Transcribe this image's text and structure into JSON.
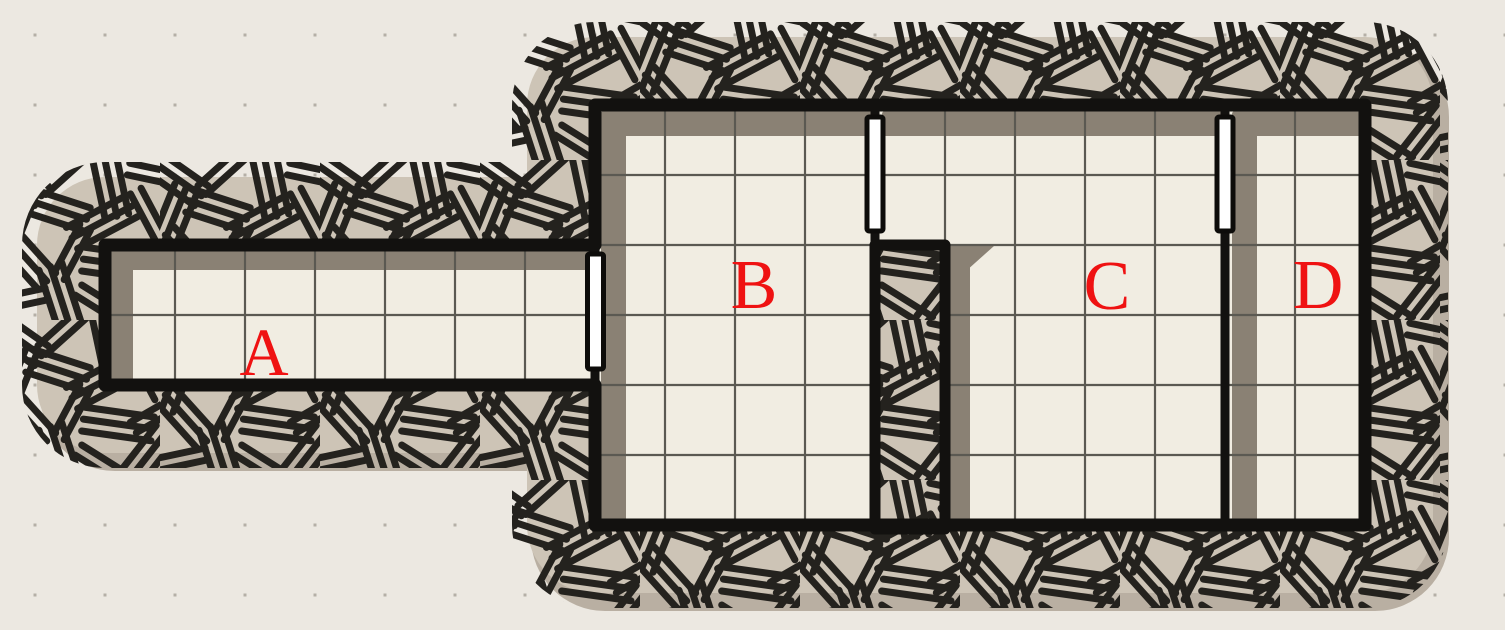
{
  "map": {
    "title": "dungeon-map",
    "canvas": {
      "width": 1505,
      "height": 630
    },
    "colors": {
      "background": "#ECE8E1",
      "dot": "#B5AFA6",
      "rock_fill": "#CDC4B6",
      "drop_shadow": "#B9AFA2",
      "hatch_ink": "#24221E",
      "wall_ink": "#12110F",
      "floor": "#F1EDE2",
      "floor_grid": "#5B5952",
      "inner_shadow": "#8A8174",
      "door_fill": "#FFFFFF",
      "door_stroke": "#0D0C0A",
      "label": "#EF1212"
    },
    "grid": {
      "cell_px": 70,
      "offset_px": 35,
      "dot_size_px": 3
    },
    "outline_points": [
      [
        105,
        245
      ],
      [
        595,
        245
      ],
      [
        595,
        105
      ],
      [
        1365,
        105
      ],
      [
        1365,
        525
      ],
      [
        595,
        525
      ],
      [
        595,
        385
      ],
      [
        105,
        385
      ]
    ],
    "rooms": [
      {
        "id": "room-a",
        "label": "A",
        "kind": "corridor",
        "rect": [
          105,
          245,
          490,
          140
        ],
        "label_pos": [
          264,
          375
        ],
        "label_size": 68
      },
      {
        "id": "room-b",
        "label": "B",
        "kind": "room",
        "rect": [
          595,
          105,
          280,
          420
        ],
        "label_pos": [
          754,
          308
        ],
        "label_size": 70
      },
      {
        "id": "room-c",
        "label": "C",
        "kind": "room",
        "rect": [
          875,
          105,
          350,
          420
        ],
        "label_pos": [
          1107,
          309
        ],
        "label_size": 70
      },
      {
        "id": "room-d",
        "label": "D",
        "kind": "room",
        "rect": [
          1225,
          105,
          140,
          420
        ],
        "label_pos": [
          1318,
          308
        ],
        "label_size": 70
      }
    ],
    "pillar": {
      "rect": [
        875,
        245,
        70,
        284
      ]
    },
    "inner_walls": [
      {
        "id": "wall-c-d",
        "x1": 1225,
        "y1": 233,
        "x2": 1225,
        "y2": 525,
        "width": 9
      }
    ],
    "wall_stubs": [
      {
        "x1": 595,
        "y1": 245,
        "x2": 595,
        "y2": 258
      },
      {
        "x1": 595,
        "y1": 368,
        "x2": 595,
        "y2": 385
      },
      {
        "x1": 875,
        "y1": 105,
        "x2": 875,
        "y2": 119
      },
      {
        "x1": 875,
        "y1": 228,
        "x2": 875,
        "y2": 250
      },
      {
        "x1": 1225,
        "y1": 105,
        "x2": 1225,
        "y2": 119
      },
      {
        "x1": 1225,
        "y1": 228,
        "x2": 1225,
        "y2": 245
      }
    ],
    "doors": [
      {
        "id": "door-a-b",
        "between": "A-B",
        "rect": [
          587.5,
          254,
          16,
          115
        ]
      },
      {
        "id": "door-b-c",
        "between": "B-C",
        "rect": [
          867,
          117,
          16,
          114
        ]
      },
      {
        "id": "door-c-d",
        "between": "C-D",
        "rect": [
          1217,
          117,
          16,
          114
        ]
      }
    ],
    "shadow_bands": [
      [
        110,
        249,
        482,
        21
      ],
      [
        110,
        249,
        23,
        133
      ],
      [
        601,
        111,
        271,
        25
      ],
      [
        601,
        111,
        25,
        411
      ],
      [
        882,
        111,
        340,
        25
      ],
      [
        947,
        250,
        23,
        272
      ],
      [
        1232,
        111,
        25,
        411
      ],
      [
        1233,
        111,
        129,
        25
      ]
    ],
    "shadow_wedges": [
      [
        [
          947,
          246
        ],
        [
          994,
          246
        ],
        [
          947,
          288
        ]
      ]
    ]
  }
}
